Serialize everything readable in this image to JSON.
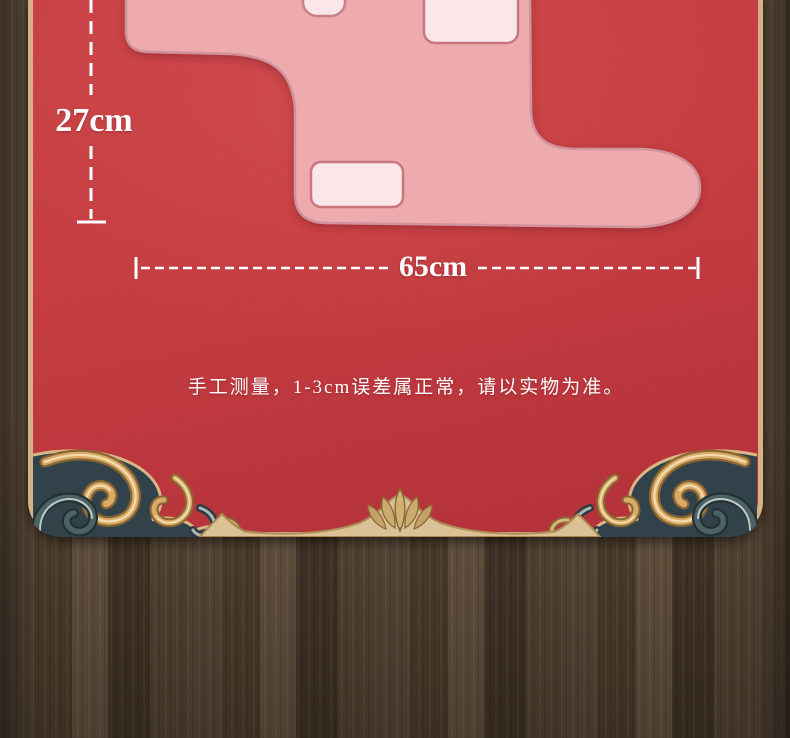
{
  "panel": {
    "height_label": "27cm",
    "width_label": "65cm",
    "note": "手工测量，1-3cm误差属正常，请以实物为准。"
  },
  "colors": {
    "fabric_red": "#c23a3e",
    "mat_pink": "#edabae",
    "pocket_pink": "#fbe7e9",
    "pocket_stroke": "#c8777f",
    "frame_gold": "#d6b184",
    "wood_brown": "#52422f",
    "dimension_white": "#ffffff",
    "ornament_gold": "#c89c5e",
    "ornament_slate": "#3a4c50"
  },
  "ornaments": {
    "bottom_left": "baroque-scroll-ornament",
    "bottom_right": "baroque-scroll-ornament",
    "bottom_center": "leaf-crest-ornament"
  }
}
